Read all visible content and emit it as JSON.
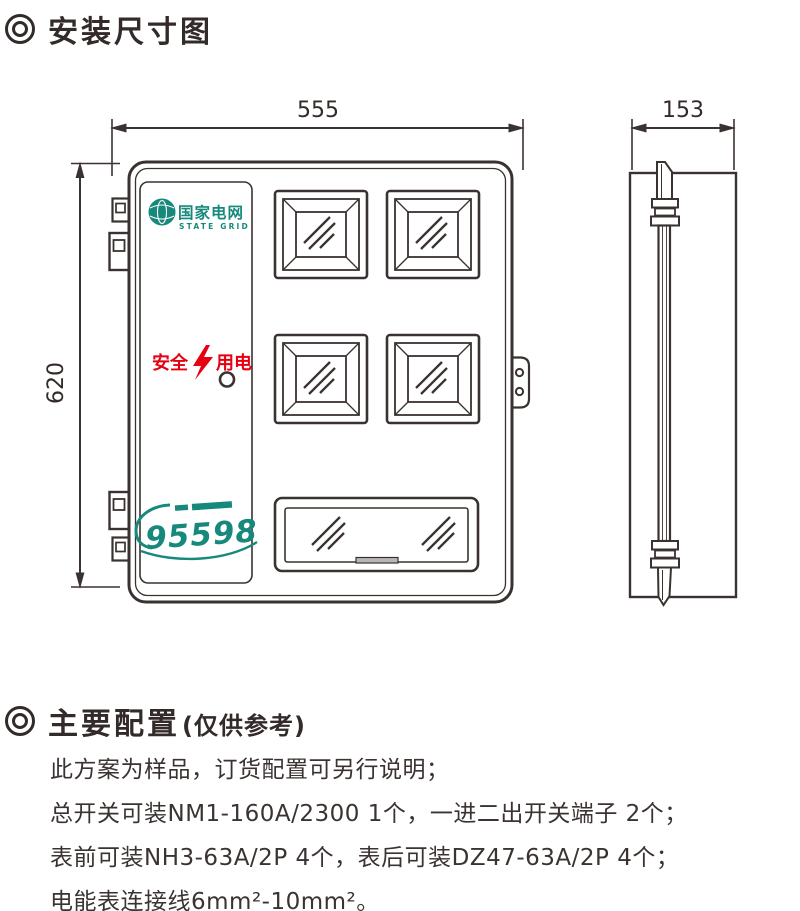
{
  "titles": {
    "diagram": "安装尺寸图",
    "config": "主要配置",
    "config_note": "(仅供参考)"
  },
  "dimensions": {
    "width": "555",
    "height": "620",
    "depth": "153"
  },
  "box": {
    "brand": {
      "cn": "国家电网",
      "en": "STATE GRID"
    },
    "safety": {
      "left": "安全",
      "right": "用电"
    },
    "hotline": "95598"
  },
  "config": {
    "lines": [
      "此方案为样品，订货配置可另行说明；",
      "总开关可装NM1-160A/2300 1个，一进二出开关端子 2个；",
      "表前可装NH3-63A/2P 4个，表后可装DZ47-63A/2P 4个；",
      "电能表连接线6mm²-10mm²。"
    ]
  },
  "colors": {
    "line": "#3a3230",
    "teal": "#17897c",
    "red": "#e60012"
  }
}
